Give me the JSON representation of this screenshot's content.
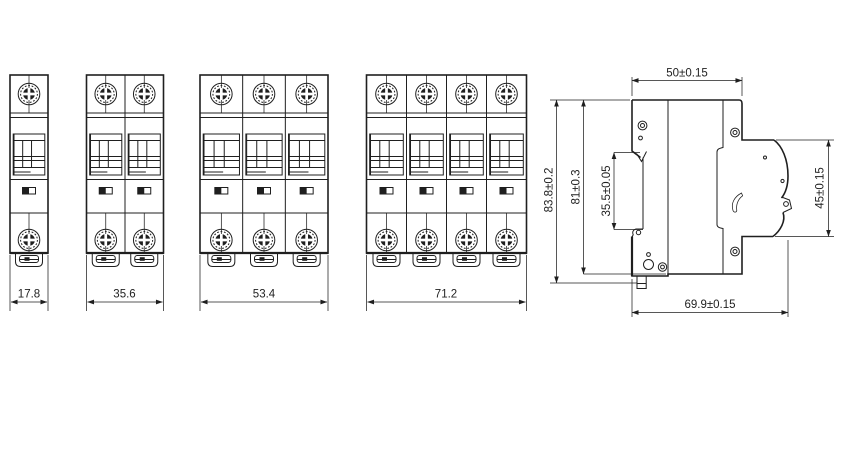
{
  "drawing": {
    "title": "MCB circuit breaker dimensional drawing",
    "line_color": "#1f1f1f",
    "background_color": "#ffffff"
  },
  "front_views": [
    {
      "name": "1-pole",
      "poles": 1,
      "width_label": "17.8"
    },
    {
      "name": "2-pole",
      "poles": 2,
      "width_label": "35.6"
    },
    {
      "name": "3-pole",
      "poles": 3,
      "width_label": "53.4"
    },
    {
      "name": "4-pole",
      "poles": 4,
      "width_label": "71.2"
    }
  ],
  "side_view": {
    "labels": {
      "top_width": "50±0.15",
      "overall_height": "83.8±0.2",
      "body_height": "81±0.3",
      "din_recess_height": "35.5±0.05",
      "front_height": "45±0.15",
      "overall_depth": "69.9±0.15"
    }
  }
}
